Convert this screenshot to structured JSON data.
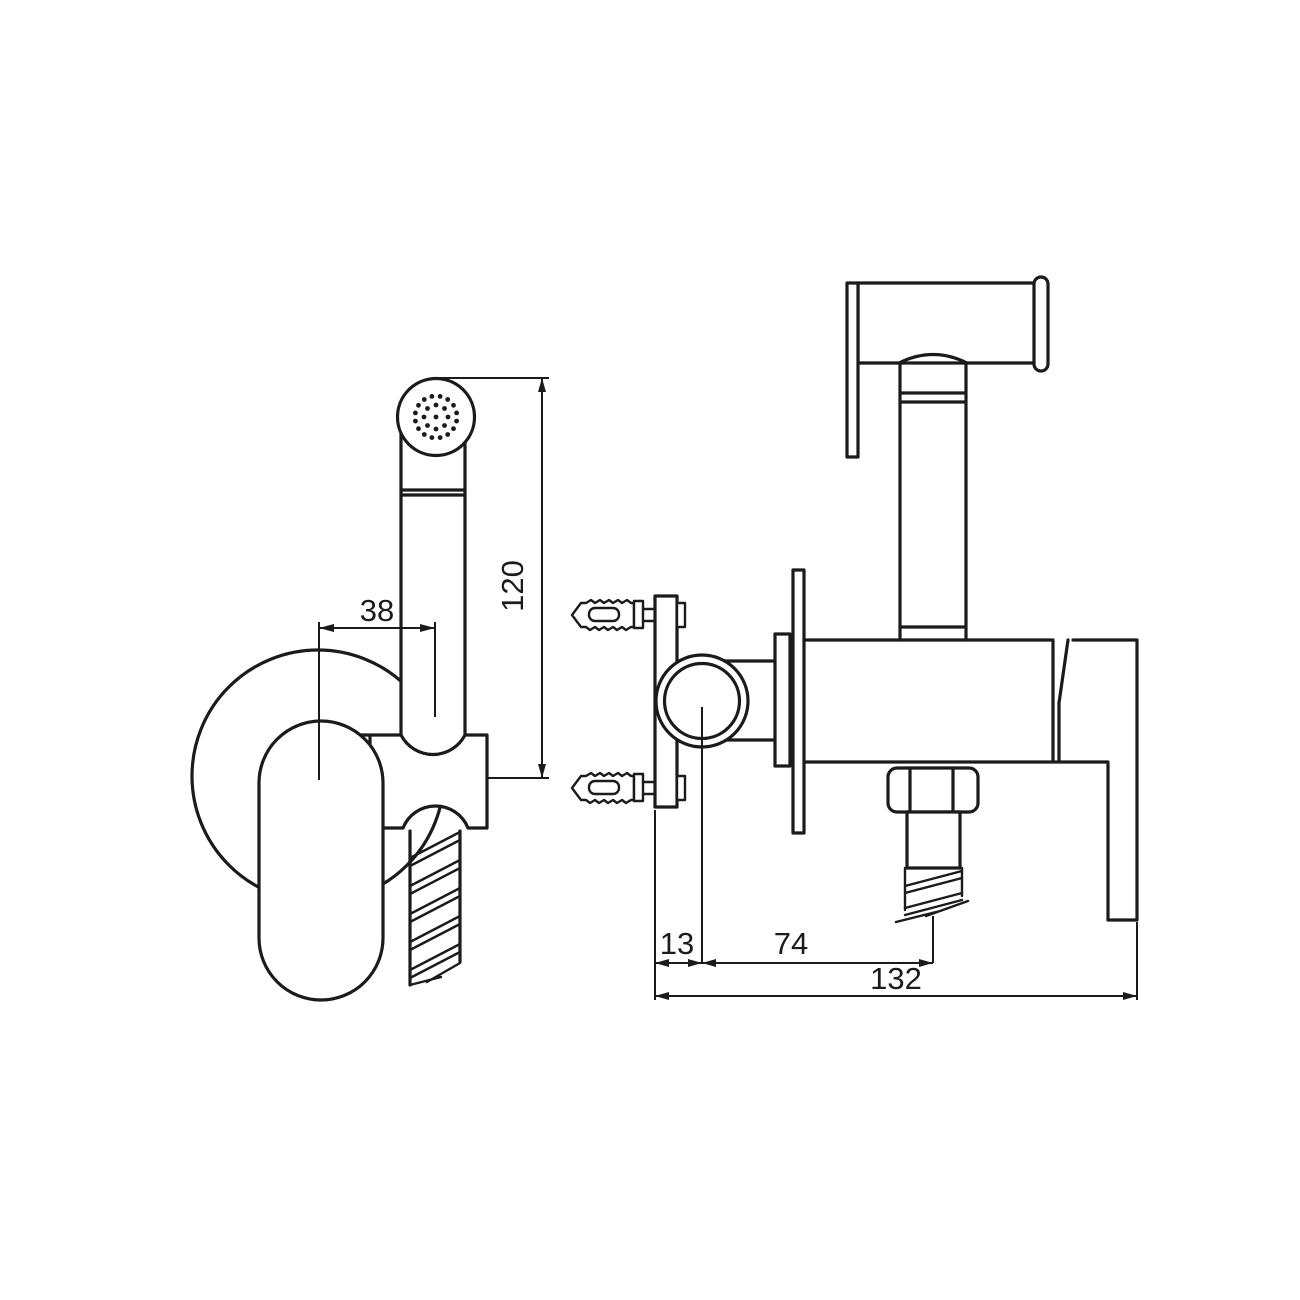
{
  "page": {
    "background_color": "#ffffff",
    "line_color": "#1b1b1b"
  },
  "drawing": {
    "type": "orthographic technical drawing",
    "subject": "wall-mounted hand-held bidet shower set with holder, hose and angle valve",
    "views": [
      {
        "id": "front",
        "name": "front view"
      },
      {
        "id": "side",
        "name": "side view"
      }
    ],
    "dimensions": {
      "grip_to_handset": {
        "label": "38",
        "view": "front",
        "orientation": "horizontal"
      },
      "handset_height": {
        "label": "120",
        "view": "front",
        "orientation": "vertical"
      },
      "wall_to_valve_center": {
        "label": "13",
        "view": "side",
        "orientation": "horizontal"
      },
      "valve_center_to_outlet": {
        "label": "74",
        "view": "side",
        "orientation": "horizontal"
      },
      "overall_depth": {
        "label": "132",
        "view": "side",
        "orientation": "horizontal"
      }
    }
  }
}
